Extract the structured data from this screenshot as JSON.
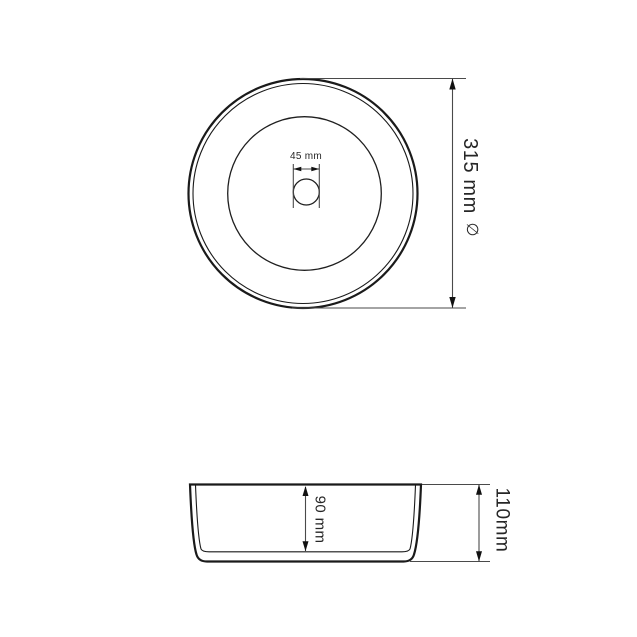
{
  "top_view": {
    "drain_dimension_label": "45 mm",
    "diameter_dimension_label": "315 mm",
    "diameter_symbol": "∅"
  },
  "side_view": {
    "inner_depth_label": "90 mm",
    "overall_height_label": "110mm"
  },
  "colors": {
    "outline": "#1a1a1a",
    "dimension_line": "#4a4a4a",
    "diameter_symbol": "#9a9a9a",
    "background": "#ffffff"
  }
}
